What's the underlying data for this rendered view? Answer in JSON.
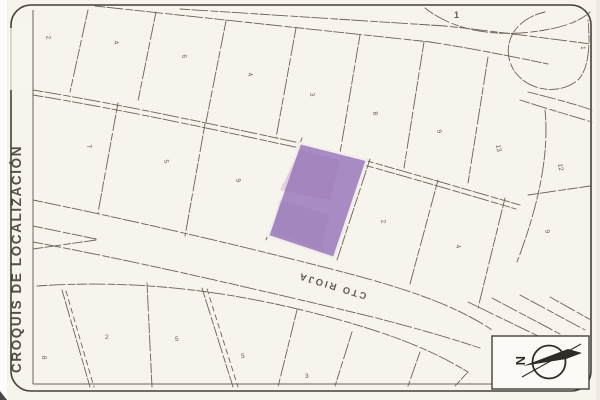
{
  "title": "CROQUIS DE LOCALIZACIÓN",
  "streets": {
    "main_label": "CTO RIOJA"
  },
  "compass": {
    "north_label": "N"
  },
  "highlighted_lot": {
    "color": "#a98bc4"
  },
  "colors": {
    "paper": "#f7f4ed",
    "lot_line": "#6f6054",
    "frame": "#45403a",
    "ink": "#2f2b27",
    "highlight": "#a98bc4"
  },
  "lot_labels": [
    {
      "text": "2"
    },
    {
      "text": "4"
    },
    {
      "text": "6"
    },
    {
      "text": "4"
    },
    {
      "text": "3"
    },
    {
      "text": "8"
    },
    {
      "text": "9"
    },
    {
      "text": "13"
    },
    {
      "text": "12"
    },
    {
      "text": "1"
    },
    {
      "text": "7"
    },
    {
      "text": "5"
    },
    {
      "text": "9"
    },
    {
      "text": "2"
    },
    {
      "text": "4"
    },
    {
      "text": "9"
    },
    {
      "text": "8"
    },
    {
      "text": "2"
    },
    {
      "text": "5"
    },
    {
      "text": "5"
    },
    {
      "text": "3"
    },
    {
      "text": "1"
    }
  ]
}
